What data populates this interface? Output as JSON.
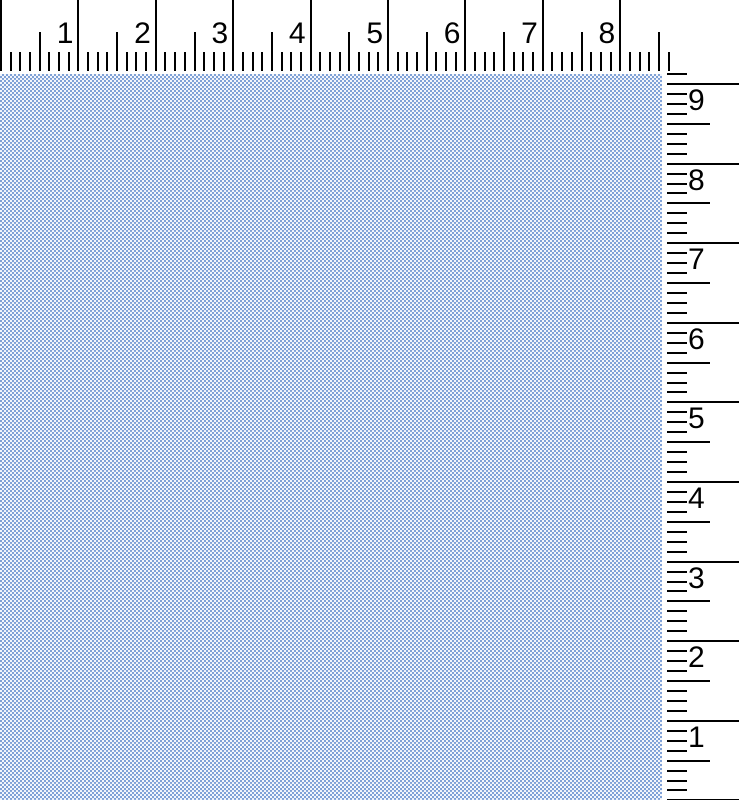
{
  "colors": {
    "background": "#ffffff",
    "tick": "#000000",
    "label_text": "#000000",
    "fabric_blue": "#7fa1d7",
    "fabric_white": "#f3f6fc"
  },
  "top_ruler": {
    "unit": "inches",
    "labels": [
      "1",
      "2",
      "3",
      "4",
      "5",
      "6",
      "7",
      "8"
    ],
    "pixels_per_inch": 77.4,
    "ticks_per_inch": 8,
    "length_px": 671,
    "height_px": 72
  },
  "right_ruler": {
    "unit": "inches",
    "labels": [
      "9",
      "8",
      "7",
      "6",
      "5",
      "4",
      "3",
      "2",
      "1"
    ],
    "pixels_per_inch": 79.6,
    "ticks_per_inch": 8,
    "first_inch_offset_px": 10,
    "length_px": 727,
    "width_px": 72
  },
  "fabric": {
    "pattern": "pincheck",
    "check_size_px": 2
  }
}
